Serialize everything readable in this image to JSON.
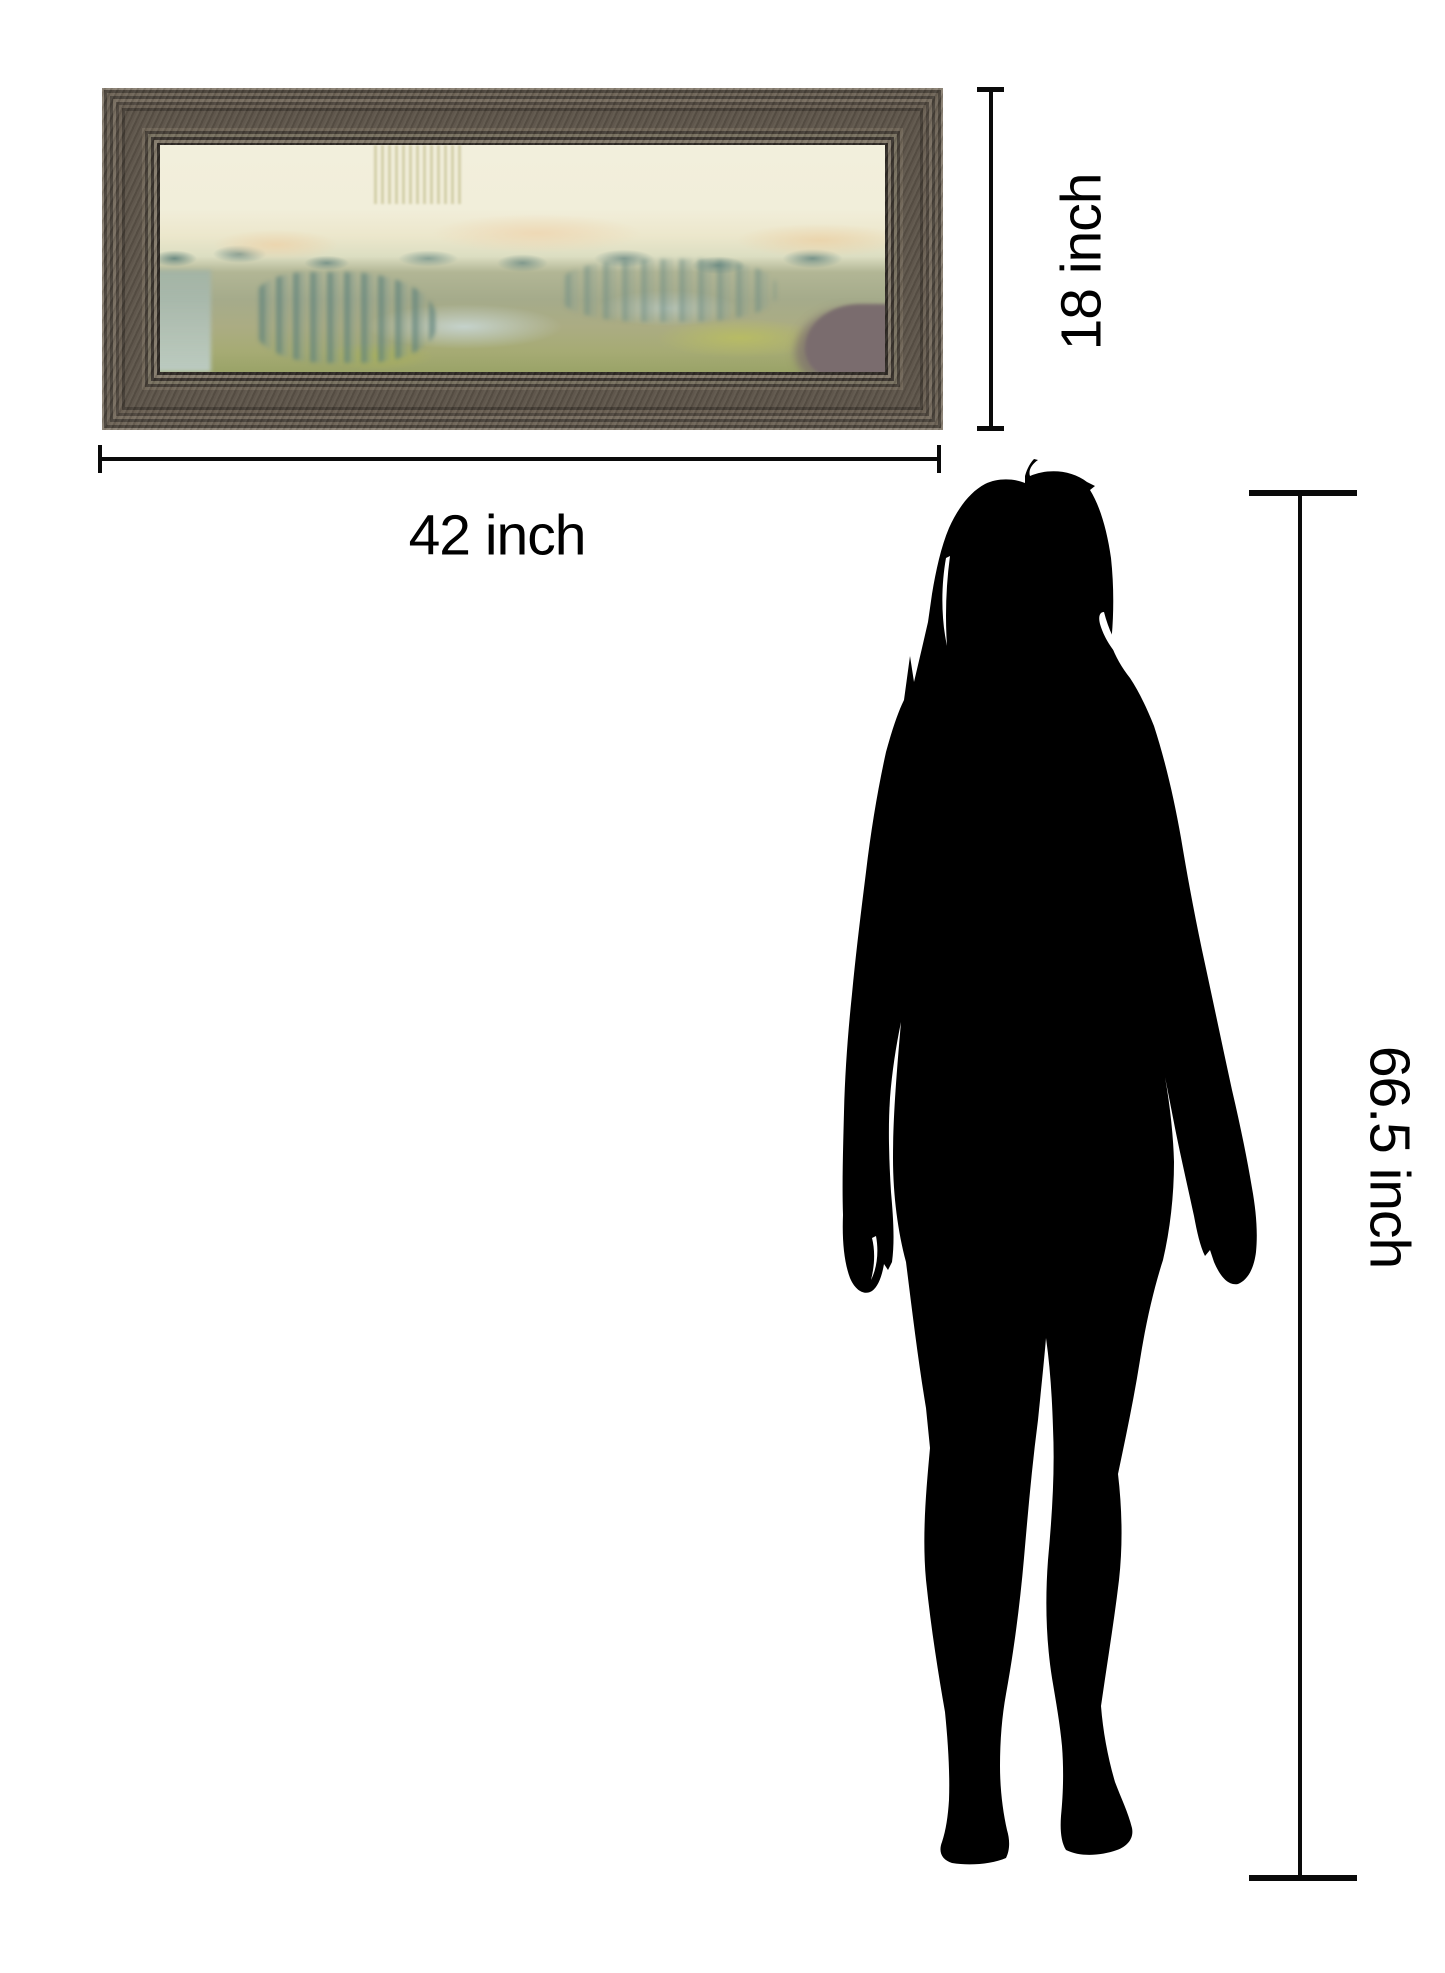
{
  "artwork": {
    "description": "abstract-landscape-framed-print",
    "frame_colors": {
      "base": "#5c5348",
      "ridge_light": "#8a8173",
      "ridge_dark": "#443d35",
      "lip_light": "#83796a",
      "inner_shadow": "#2f2a25"
    },
    "painting_colors": {
      "sky_cream": "#f2efdc",
      "peach": "#ecd5ae",
      "horizon_teal": "#6f8d85",
      "sage_green": "#a5ab8b",
      "yellow_green": "#b9bd62",
      "blue_mist": "#c6d4cf",
      "mauve_blob": "#7a6c6e",
      "bottom_olive": "#9aa368"
    }
  },
  "annotations": {
    "line_color": "#0a0a0a",
    "width_label": "42 inch",
    "height_label": "18 inch",
    "person_height_label": "66.5 inch"
  },
  "figure": {
    "type": "woman-silhouette",
    "color": "#000000"
  },
  "page_background": "#ffffff"
}
